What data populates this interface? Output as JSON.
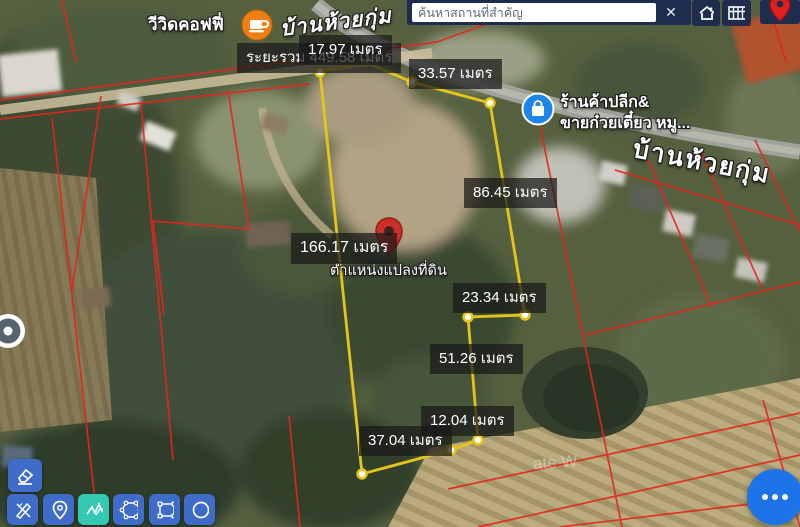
{
  "topbar": {
    "search_placeholder": "ค้นหาสถานที่สำคัญ",
    "close": "✕",
    "icons": [
      "home-icon",
      "parcel-grid-icon",
      "red-marker-icon"
    ]
  },
  "poi": {
    "coffee_shop": "วีวิดคอฟฟี่",
    "coffee_icon": "coffee-cup-icon",
    "village_top": "บ้านห้วยกุ่ม",
    "shop_line1": "ร้านค้าปลีก&",
    "shop_line2": "ขายก๋วยเตี๋ยว หมู...",
    "shop_icon": "shopping-bag-icon",
    "road_name": "บ้านห้วยกุ่ม",
    "land_position": "ตำแหน่งแปลงที่ดิน",
    "watermark": "ate W"
  },
  "measurements": {
    "total": "ระยะรวม 449.58 เมตร",
    "unit": "เมตร",
    "segments": [
      {
        "text": "17.97 เมตร"
      },
      {
        "text": "33.57 เมตร"
      },
      {
        "text": "86.45 เมตร"
      },
      {
        "text": "166.17 เมตร"
      },
      {
        "text": "23.34 เมตร"
      },
      {
        "text": "51.26 เมตร"
      },
      {
        "text": "12.04 เมตร"
      },
      {
        "text": "37.04 เมตร"
      }
    ]
  },
  "toolbar": {
    "tools": [
      "eraser-icon",
      "draw-pencil-ruler-icon",
      "drop-pin-icon",
      "measure-polyline-icon",
      "draw-polygon-icon",
      "draw-rectangle-icon",
      "draw-circle-icon"
    ],
    "active_tool": "measure-polyline-icon"
  },
  "fab": {
    "icon": "more-dots-icon"
  },
  "colors": {
    "accent_yellow": "#e6c51a",
    "parcel_red": "#e3261d",
    "toolbar_blue": "#3f6cc8",
    "active_teal": "#35c9b2",
    "fab_blue": "#1d73e8",
    "topbar_navy": "#1e2c4d",
    "coffee_orange": "#f07f13",
    "shop_blue": "#1d86e8",
    "land_pin_red": "#cc2f28"
  }
}
